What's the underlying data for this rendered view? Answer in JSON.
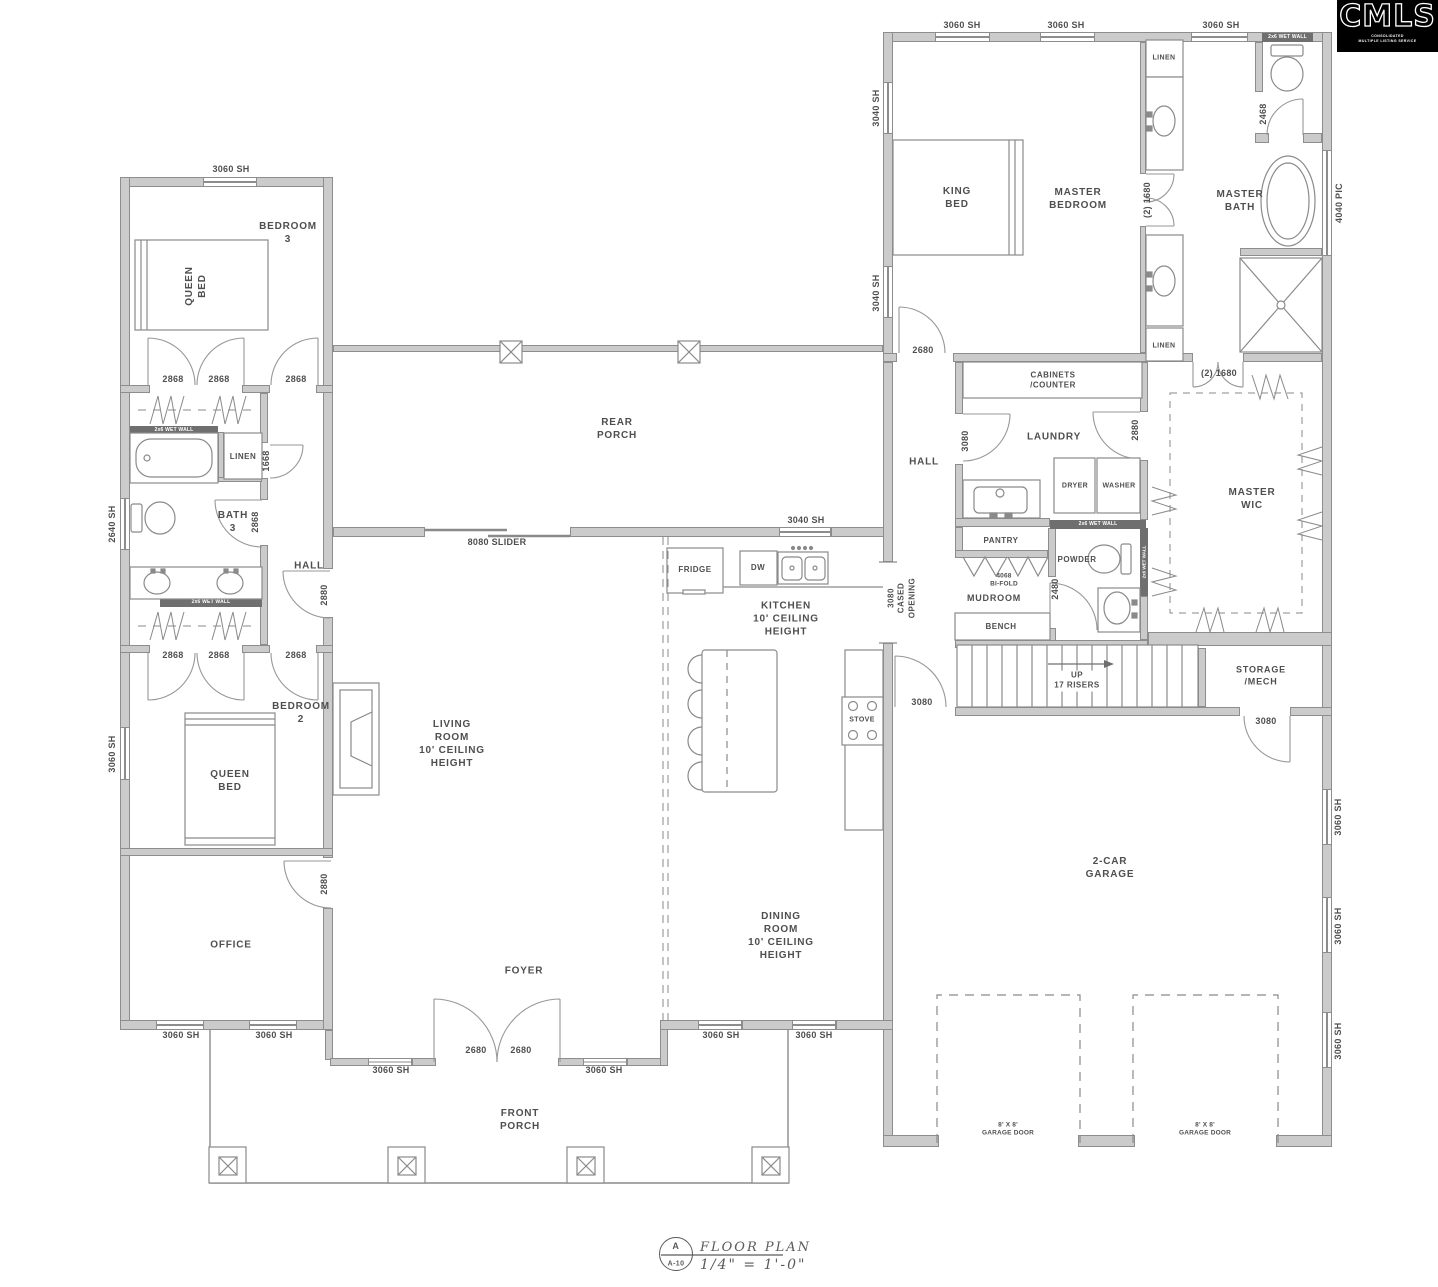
{
  "branding": {
    "logo_text": "CMLS",
    "logo_sub": "CONSOLIDATED\nMULTIPLE LISTING SERVICE"
  },
  "title_block": {
    "detail_letter": "A",
    "sheet_number": "A-10",
    "drawing_title": "FLOOR PLAN",
    "scale": "1/4\" = 1'-0\""
  },
  "rooms": {
    "bedroom3": "BEDROOM\n3",
    "bath3": "BATH\n3",
    "hall_left": "HALL",
    "bedroom2": "BEDROOM\n2",
    "office": "OFFICE",
    "rear_porch": "REAR\nPORCH",
    "living_room": "LIVING\nROOM\n10' CEILING\nHEIGHT",
    "foyer": "FOYER",
    "kitchen": "KITCHEN\n10' CEILING\nHEIGHT",
    "dining_room": "DINING\nROOM\n10' CEILING\nHEIGHT",
    "front_porch": "FRONT\nPORCH",
    "master_bedroom": "MASTER\nBEDROOM",
    "master_bath": "MASTER\nBATH",
    "hall_right": "HALL",
    "laundry": "LAUNDRY",
    "cabinets": "CABINETS\n/COUNTER",
    "pantry": "PANTRY",
    "powder": "POWDER",
    "mudroom": "MUDROOM",
    "bench": "BENCH",
    "master_wic": "MASTER\nWIC",
    "stairs": "UP\n17 RISERS",
    "storage": "STORAGE\n/MECH",
    "garage": "2-CAR\nGARAGE",
    "linen": "LINEN"
  },
  "fixtures": {
    "king_bed": "KING\nBED",
    "queen_bed": "QUEEN\nBED",
    "fridge": "FRIDGE",
    "dw": "DW",
    "stove": "STOVE",
    "dryer": "DRYER",
    "washer": "WASHER"
  },
  "openings": {
    "w3060": "3060 SH",
    "w3040": "3040 SH",
    "w2640": "2640 SH",
    "w4040": "4040 PIC",
    "d2868": "2868",
    "d2880": "2880",
    "d2680": "2680",
    "d3080": "3080",
    "d2480": "2480",
    "d2468": "2468",
    "d1668": "1668",
    "double1680": "(2) 1680",
    "slider": "8080 SLIDER",
    "cased_opening": "3080\nCASED\nOPENING",
    "bifold": "4068\nBI-FOLD",
    "garage_door": "8' X 8'\nGARAGE DOOR",
    "wet_wall": "2x6 WET WALL"
  }
}
